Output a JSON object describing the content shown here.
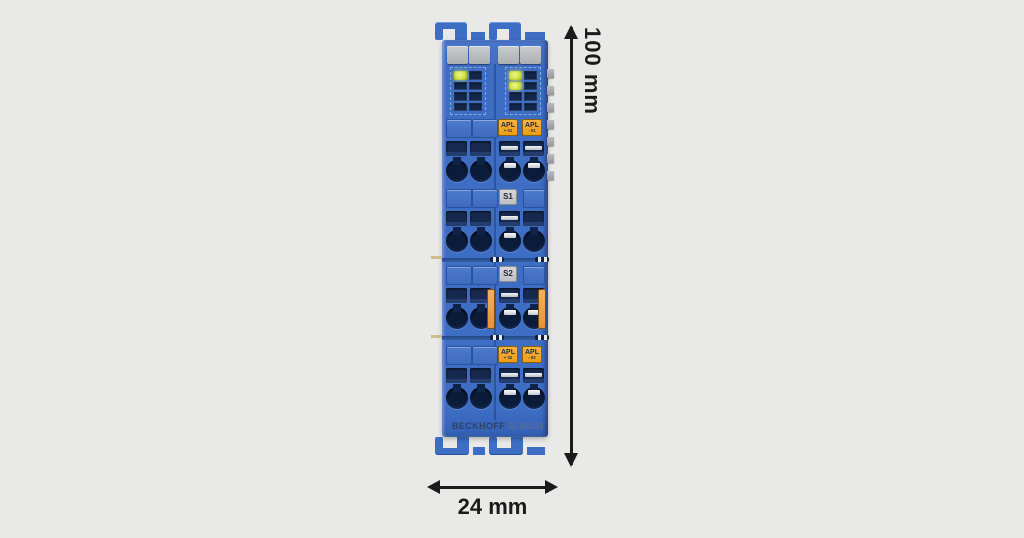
{
  "module": {
    "brand": "BECKHOFF",
    "model": "ELX6233",
    "labels": {
      "apl_top": [
        {
          "line1": "APL",
          "line2": "+ 01"
        },
        {
          "line1": "APL",
          "line2": "- 01"
        }
      ],
      "apl_bottom": [
        {
          "line1": "APL",
          "line2": "+ 02"
        },
        {
          "line1": "APL",
          "line2": "- 02"
        }
      ],
      "s1": "S1",
      "s2": "S2"
    },
    "leds": {
      "left": [
        "on",
        "off",
        "off",
        "off",
        "off",
        "off",
        "off",
        "off"
      ],
      "right": [
        "on",
        "off",
        "on",
        "off",
        "off",
        "off",
        "off",
        "off"
      ]
    },
    "colors": {
      "body_blue": "#3e6dc4",
      "slot_navy": "#16294f",
      "label_orange": "#f2a51f",
      "led_on_green": "#cfe23f",
      "gray_label": "#c6c8ca",
      "background": "#e9e9e7",
      "annotation": "#1b1b1b"
    }
  },
  "dimensions": {
    "height_label": "100 mm",
    "width_label": "24 mm"
  }
}
